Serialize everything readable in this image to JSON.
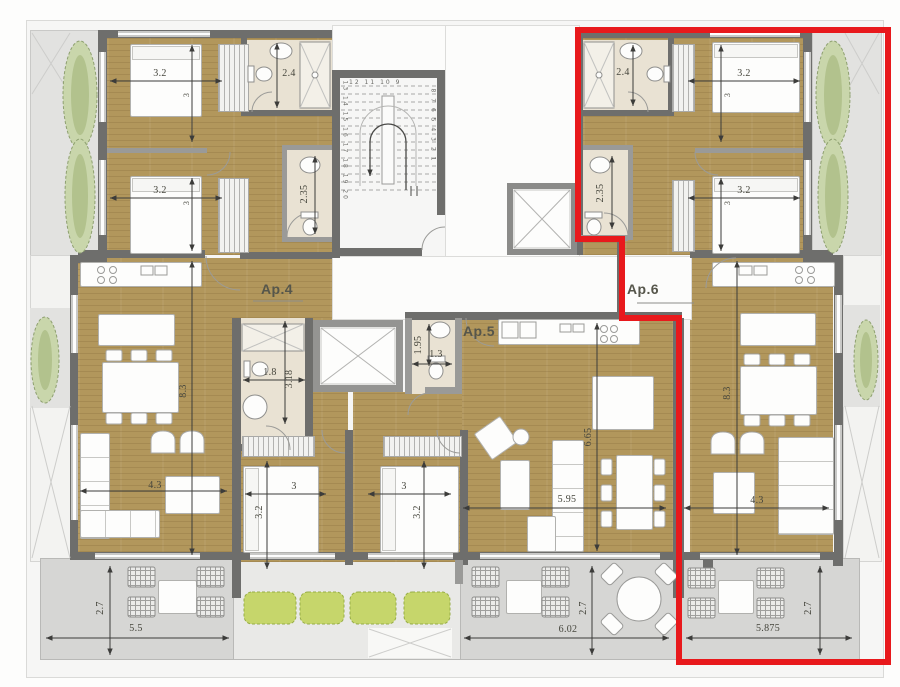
{
  "apartments": {
    "ap4": "Ap.4",
    "ap5": "Ap.5",
    "ap6": "Ap.6"
  },
  "dims": {
    "tl_bed1": "3.2",
    "tl_bed1_d": "3",
    "tl_bed2": "3.2",
    "tl_bed2_d": "3",
    "tl_bath": "2.4",
    "tl_wc": "2.35",
    "tr_bed1": "3.2",
    "tr_bed1_d": "3",
    "tr_bed2": "3.2",
    "tr_bed2_d": "3",
    "tr_bath": "2.4",
    "tr_wc": "2.35",
    "ap4_h": "8.3",
    "ap4_w": "4.3",
    "ap4_bath_w": "1.8",
    "ap4_bath_h": "3.18",
    "ap5_bath_h": "1.95",
    "ap5_bath_w": "1.3",
    "ap5_h": "6.65",
    "ap5_w": "5.95",
    "ap6_h": "8.3",
    "ap6_w": "4.3",
    "cbed1_w": "3",
    "cbed1_h": "3.2",
    "cbed2_w": "3",
    "cbed2_h": "3.2",
    "terr_l_w": "5.5",
    "terr_l_h": "2.7",
    "terr_m_w": "6.02",
    "terr_m_h": "2.7",
    "terr_r_w": "5.875",
    "terr_r_h": "2.7"
  },
  "stairs": {
    "left": "13 14 15 16 17 18 19 20",
    "top": "12 11 10 9",
    "right": "8 7 6 5 4 3 2 1"
  },
  "highlight": {
    "apartment": "Ap.6",
    "color": "#e8191c"
  }
}
